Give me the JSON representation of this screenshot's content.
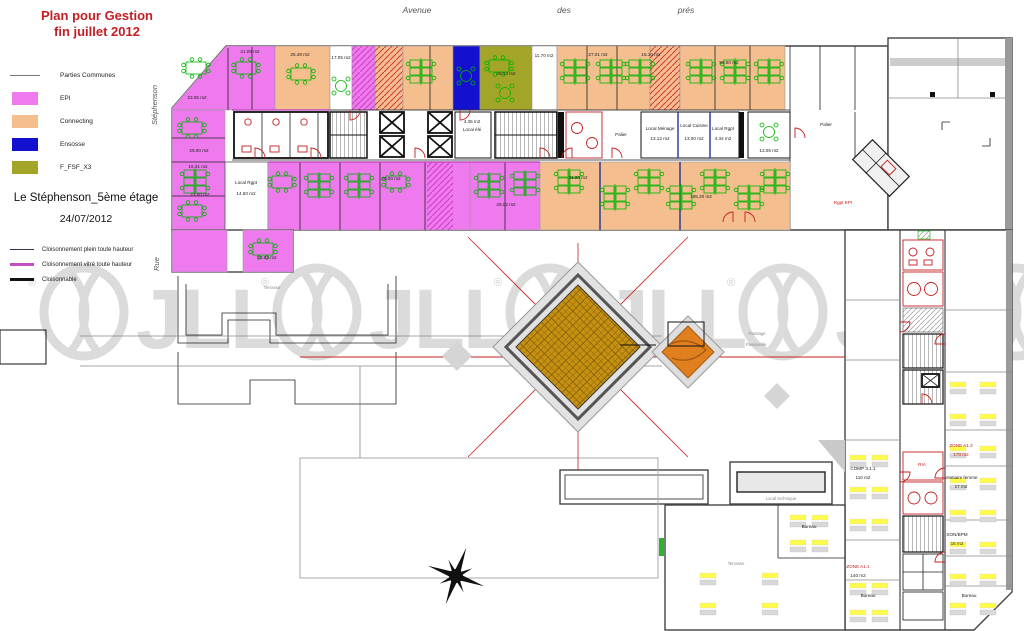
{
  "title": {
    "line1": "Plan pour Gestion",
    "line2": "fin juillet 2012",
    "color": "#C41E25"
  },
  "building": {
    "name": "Le Stéphenson_5ème étage",
    "date": "24/07/2012"
  },
  "legend_zones": {
    "items": [
      {
        "label": "Parties Communes",
        "swatch": "line",
        "color": "#777777"
      },
      {
        "label": "EPI",
        "swatch": "rect",
        "color": "#EE7AEE"
      },
      {
        "label": "Connecting",
        "swatch": "rect",
        "color": "#F4BE8E"
      },
      {
        "label": "Ensosse",
        "swatch": "rect",
        "color": "#1310CF"
      },
      {
        "label": "F_FSF_X3",
        "swatch": "rect",
        "color": "#A3A529"
      }
    ]
  },
  "legend_partitions": {
    "items": [
      {
        "label": "Cloisonnement plein toute hauteur",
        "color": "#333355",
        "weight": "thin"
      },
      {
        "label": "Cloisonnement vitré toute hauteur",
        "color": "#C050C0",
        "weight": "thick"
      },
      {
        "label": "Cloisonnable",
        "color": "#111111",
        "weight": "thick"
      }
    ]
  },
  "streets": {
    "top1": "Avenue",
    "top2": "des",
    "top3": "prés",
    "left_top": "Stéphenson",
    "left_bottom": "Rue"
  },
  "watermark": {
    "text": "JLL",
    "registered": "®",
    "color": "#DBDBDB"
  },
  "icons": {
    "compass": "8-point-star",
    "jll-globe": "circle-with-meridians"
  },
  "plan": {
    "labels": [
      {
        "text": "23.05 m2"
      },
      {
        "text": "21.05 m2"
      },
      {
        "text": "25.48 m2"
      },
      {
        "text": "17.05 m2"
      },
      {
        "text": "25.13 m2"
      },
      {
        "text": "11.70 m2"
      },
      {
        "text": "27.01 m2"
      },
      {
        "text": "16.10 m2"
      },
      {
        "text": "50.60 m2"
      },
      {
        "text": "29.00 m2"
      },
      {
        "text": "16.31 m2"
      },
      {
        "text": "21.00 m2"
      },
      {
        "text": "23.02 m2"
      },
      {
        "text": "Local Rgpt"
      },
      {
        "text": "14.50 m2"
      },
      {
        "text": "25.00 m2"
      },
      {
        "text": "28.02 m2"
      },
      {
        "text": "31.20 m2"
      },
      {
        "text": "165.20 m2"
      },
      {
        "text": "Local élé"
      },
      {
        "text": "4.35 m2"
      },
      {
        "text": "Palier"
      },
      {
        "text": "Local Ménage"
      },
      {
        "text": "13.12 m2"
      },
      {
        "text": "Local Cuisine"
      },
      {
        "text": "13.00 m2"
      },
      {
        "text": "Local Rgpt"
      },
      {
        "text": "4.34 m2"
      },
      {
        "text": "13.05 m2"
      },
      {
        "text": "Palier"
      },
      {
        "text": "Terrasse"
      },
      {
        "text": "Passage"
      },
      {
        "text": "Passerelle"
      },
      {
        "text": "Rgpt EPI"
      },
      {
        "text": "ZONE A1.3"
      },
      {
        "text": "170 m2"
      },
      {
        "text": "Vestiaire femme"
      },
      {
        "text": "17 m2"
      },
      {
        "text": "SON/BPM"
      },
      {
        "text": "16 m2"
      },
      {
        "text": "COMP 3.1.1"
      },
      {
        "text": "110 m2"
      },
      {
        "text": "ZONE A1.1"
      },
      {
        "text": "140 m2"
      },
      {
        "text": "Bureau"
      },
      {
        "text": "Terrasse"
      },
      {
        "text": "Bureau"
      },
      {
        "text": "Bureau"
      },
      {
        "text": "Local technique"
      },
      {
        "text": "RIA"
      }
    ]
  }
}
